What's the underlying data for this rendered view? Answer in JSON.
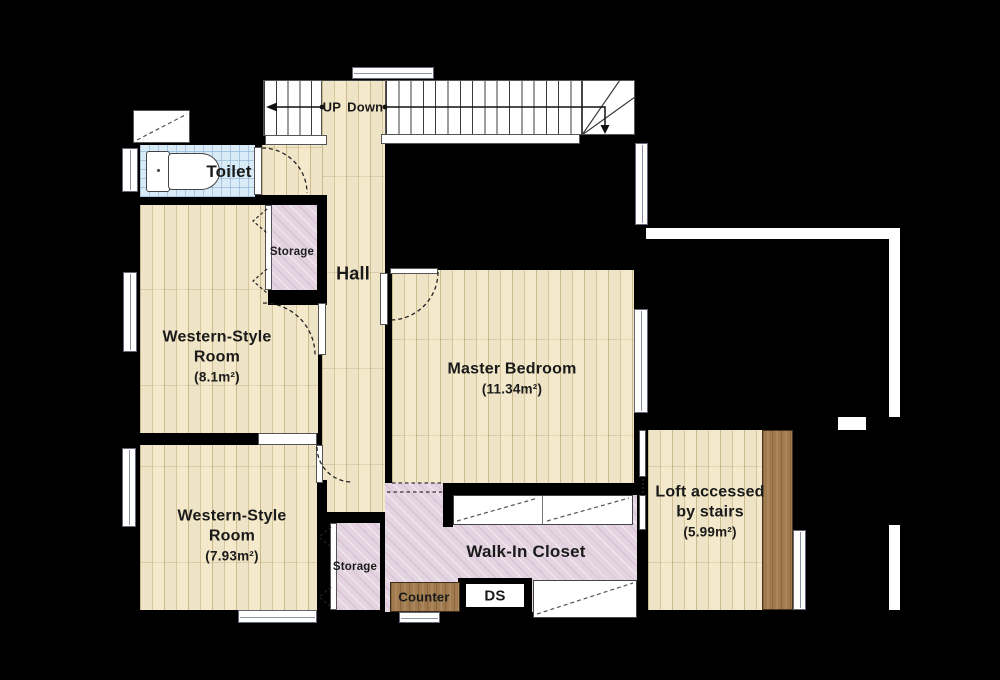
{
  "plan": {
    "colors": {
      "background": "#000000",
      "floor": "#faf3dd",
      "closet_hatch": "#e4d4e1",
      "toilet_tile": "#d9ebf7",
      "wood_accent": "#a17a4d",
      "structure_white": "#ffffff"
    },
    "stairs": {
      "up_label": "UP",
      "down_label": "Down"
    },
    "rooms": {
      "toilet": {
        "label": "Toilet"
      },
      "hall": {
        "label": "Hall"
      },
      "storage_upper": {
        "label": "Storage"
      },
      "storage_lower": {
        "label": "Storage"
      },
      "western_style_room_upper": {
        "line1": "Western-Style",
        "line2": "Room",
        "area": "(8.1m²)"
      },
      "western_style_room_lower": {
        "line1": "Western-Style",
        "line2": "Room",
        "area": "(7.93m²)"
      },
      "master_bedroom": {
        "label": "Master Bedroom",
        "area": "(11.34m²)"
      },
      "walk_in_closet": {
        "label": "Walk-In Closet"
      },
      "counter": {
        "label": "Counter"
      },
      "duct_space": {
        "label": "DS"
      },
      "loft": {
        "line1": "Loft accessed",
        "line2": "by stairs",
        "area": "(5.99m²)"
      }
    }
  }
}
